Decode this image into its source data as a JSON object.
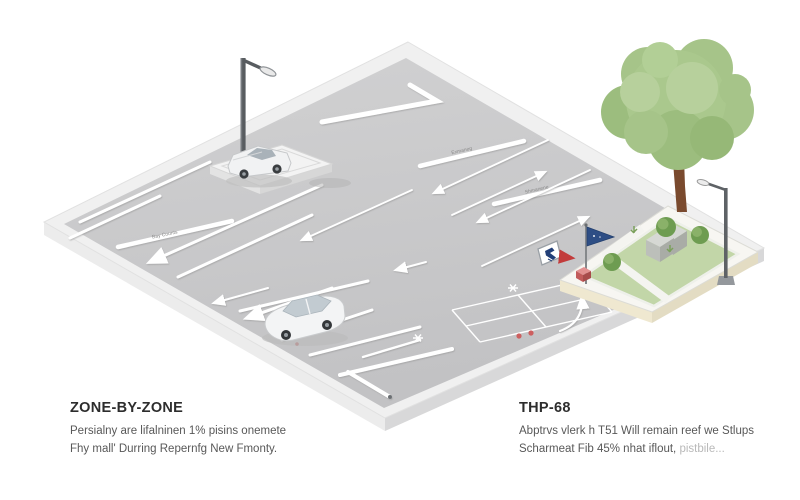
{
  "captions": {
    "left": {
      "heading": "ZONE-BY-ZONE",
      "line1": "Persialny are lifalninen 1% pisins onemete",
      "line2": "Fhy mall' Durring Repernfg New Fmonty."
    },
    "right": {
      "heading": "THP-68",
      "line1": "Abptrvs vlerk h T51 Will remain reef we Stlups",
      "line2": "Scharmeat Fib 45% nhat iflout,",
      "line2_light": " pistbile..."
    }
  },
  "illustration": {
    "stripe_labels": [
      "Bay Counts",
      "Exmaneg",
      "Shmanene"
    ],
    "colors": {
      "background": "#ffffff",
      "asphalt": "#c9c9ca",
      "sidewalk": "#f0f0f0",
      "lawn": "#c2d6a8",
      "tree_foliage": "#a6c489",
      "flag_blue": "#2e4e85",
      "accent_red": "#c23b3b"
    }
  }
}
